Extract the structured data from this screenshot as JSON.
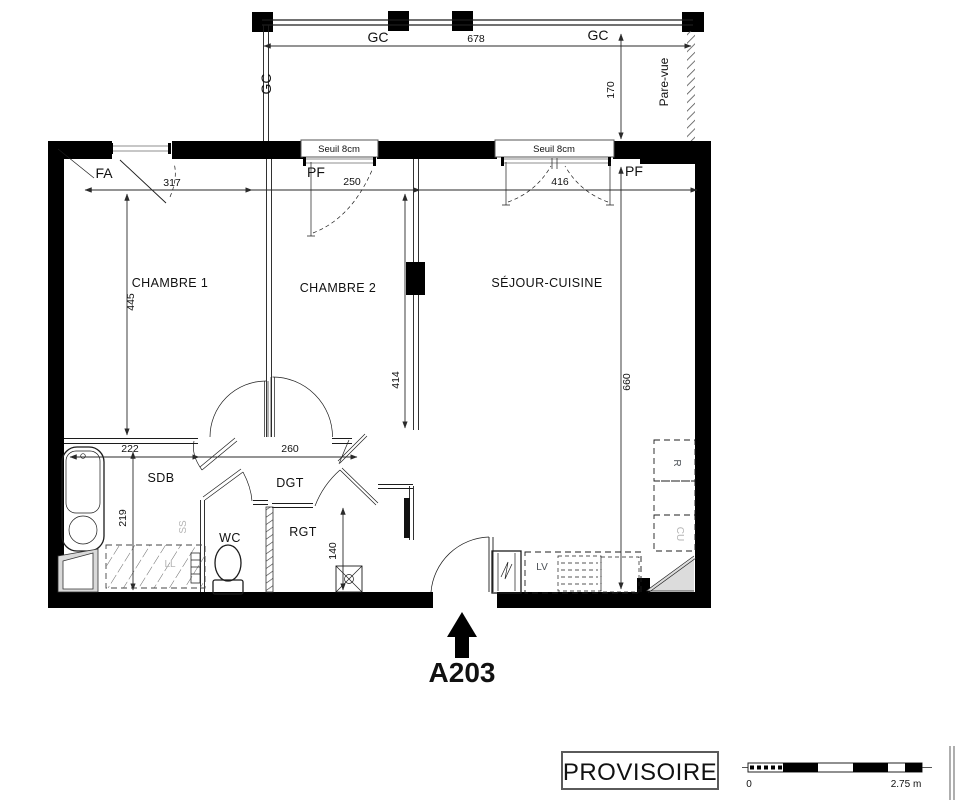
{
  "unit": {
    "label": "A203",
    "color": "#1d3a6e"
  },
  "stamp": {
    "label": "PROVISOIRE"
  },
  "rooms": {
    "chambre1": "CHAMBRE 1",
    "chambre2": "CHAMBRE 2",
    "sejour": "SÉJOUR-CUISINE",
    "sdb": "SDB",
    "dgt": "DGT",
    "wc": "WC",
    "rgt": "RGT"
  },
  "openings": {
    "fa": "FA",
    "pf1": "PF",
    "pf2": "PF",
    "seuil1": "Seuil 8cm",
    "seuil2": "Seuil 8cm"
  },
  "balcony": {
    "gc_left": "GC",
    "gc_top_left": "GC",
    "gc_top_right": "GC",
    "pare_vue": "Pare-vue"
  },
  "equipment": {
    "ss": "SS",
    "ll": "LL",
    "lv": "LV",
    "fridge": "R",
    "cooktop": "CU"
  },
  "dimensions": {
    "balcony_width": "678",
    "balcony_depth": "170",
    "chain_left": "317",
    "chain_mid": "250",
    "chain_right": "416",
    "chambre1_depth": "445",
    "chambre2_depth": "414",
    "sejour_depth": "660",
    "sdb_width": "222",
    "dgt_width": "260",
    "sdb_depth": "219",
    "rgt_depth": "140"
  },
  "scale_bar": {
    "zero": "0",
    "max": "2.75 m"
  },
  "colors": {
    "wall": "#000000",
    "line": "#1c1c1c",
    "accent_blue": "#1d3a6e",
    "light_gray": "#b5b5b5"
  }
}
